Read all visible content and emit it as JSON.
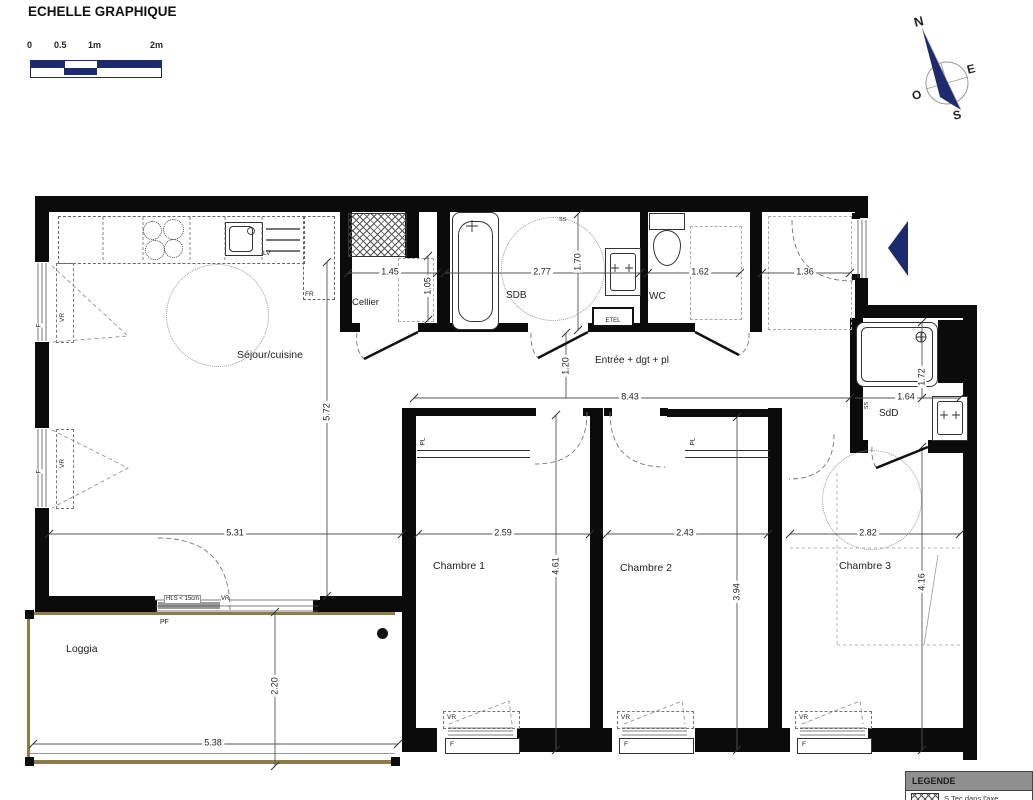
{
  "scale_bar": {
    "title": "ECHELLE GRAPHIQUE",
    "tick0": "0",
    "tick05": "0.5",
    "tick1": "1m",
    "tick2": "2m"
  },
  "compass": {
    "north": "N",
    "east": "E",
    "south": "S",
    "west": "O"
  },
  "rooms": {
    "sejour_cuisine": "Séjour/cuisine",
    "cellier": "Cellier",
    "sdb": "SDB",
    "wc": "WC",
    "entree": "Entrée + dgt + pl",
    "chambre1": "Chambre 1",
    "chambre2": "Chambre 2",
    "chambre3": "Chambre 3",
    "sdd": "SdD",
    "loggia": "Loggia"
  },
  "dims": {
    "d1_45": "1.45",
    "d1_05": "1.05",
    "d2_77": "2.77",
    "d1_70": "1.70",
    "d1_62": "1.62",
    "d1_36": "1.36",
    "d8_43": "8.43",
    "d1_20": "1.20",
    "d5_31": "5.31",
    "d5_72": "5.72",
    "d2_59": "2.59",
    "d4_61": "4.61",
    "d2_43": "2.43",
    "d3_94": "3.94",
    "d2_82": "2.82",
    "d4_16": "4.16",
    "d1_64": "1.64",
    "d1_72": "1.72",
    "d5_38": "5.38",
    "d2_20": "2.20"
  },
  "labels": {
    "lv": "LV",
    "fr": "FR",
    "vr": "VR",
    "f": "F",
    "pl": "PL",
    "ss": "SS",
    "pf": "PF",
    "etel": "ETEL",
    "hts": "Ht.S < 15cm"
  },
  "legend": {
    "title": "LEGENDE",
    "row1": "S.Tec dans l'axe"
  },
  "colors": {
    "navy": "#1e2a6e",
    "wall": "#0b0b0b",
    "loggia": "#8d7b49"
  }
}
